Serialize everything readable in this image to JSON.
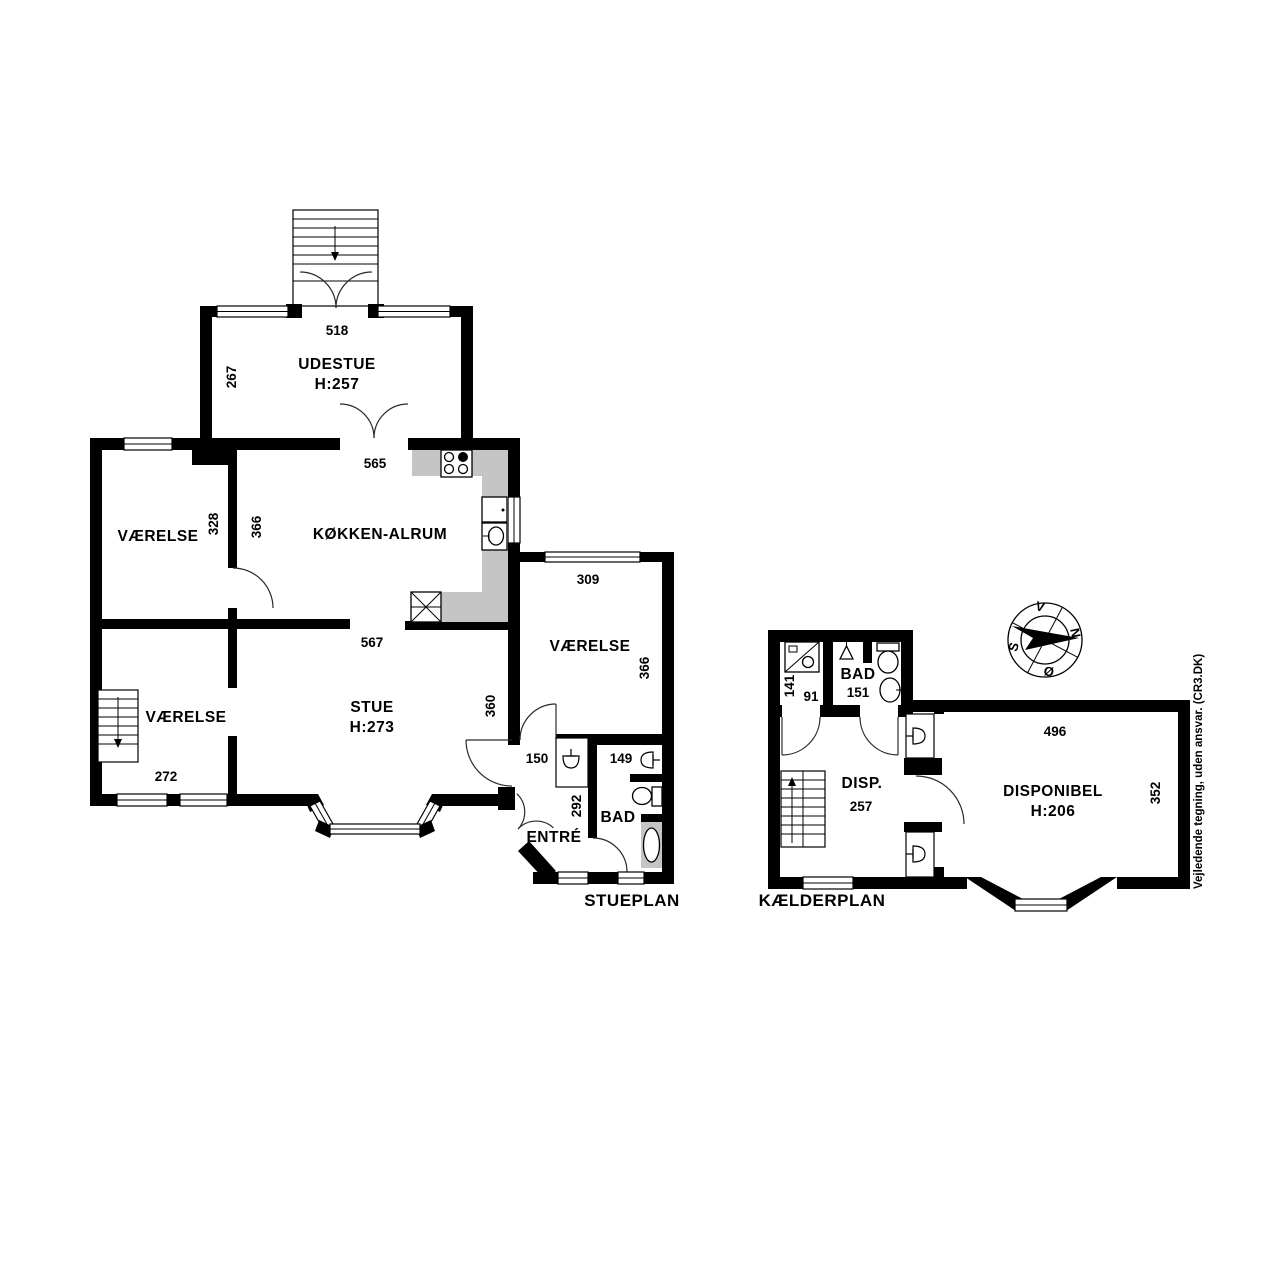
{
  "colors": {
    "wall": "#000000",
    "counter": "#c5c5c5",
    "background": "#ffffff"
  },
  "stueplan": {
    "label": "STUEPLAN",
    "udestue": {
      "name": "UDESTUE",
      "h": "H:257",
      "w": "518",
      "d": "267"
    },
    "koekken": {
      "name": "KØKKEN-ALRUM",
      "w": "565",
      "d": "366"
    },
    "vaerelse_tl": {
      "name": "VÆRELSE",
      "d": "328"
    },
    "vaerelse_bl": {
      "name": "VÆRELSE",
      "w": "272"
    },
    "stue": {
      "name": "STUE",
      "h": "H:273",
      "w": "567",
      "d": "360"
    },
    "vaerelse_r": {
      "name": "VÆRELSE",
      "w": "309",
      "d": "366"
    },
    "entre": {
      "name": "ENTRÉ",
      "w": "150",
      "d": "292"
    },
    "bad": {
      "name": "BAD",
      "w": "149"
    }
  },
  "kaelderplan": {
    "label": "KÆLDERPLAN",
    "bruser": {
      "d": "141",
      "w": "91"
    },
    "bad": {
      "name": "BAD",
      "w": "151"
    },
    "disp": {
      "name": "DISP.",
      "w": "257"
    },
    "disponibel": {
      "name": "DISPONIBEL",
      "h": "H:206",
      "w": "496",
      "d": "352"
    }
  },
  "compass": {
    "n": "N",
    "s": "S",
    "v": "V",
    "oe": "Ø"
  },
  "disclaimer": "Vejledende tegning, uden ansvar. (CR3.DK)"
}
